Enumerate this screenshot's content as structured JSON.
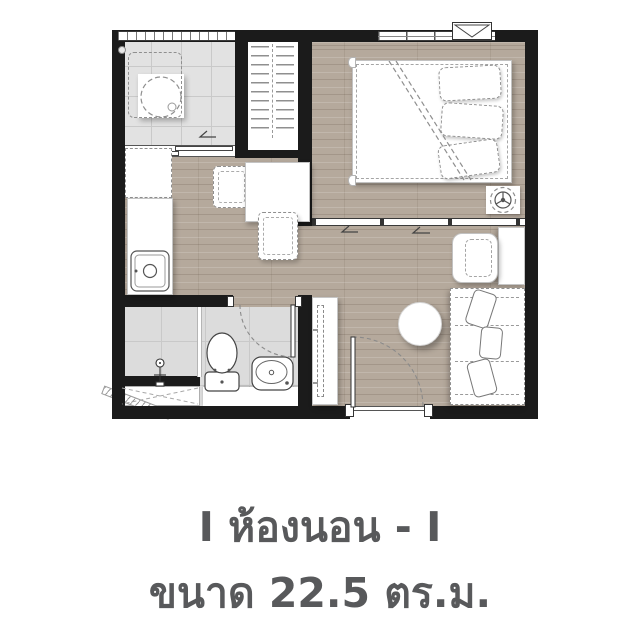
{
  "caption": {
    "line1": "I ห้องนอน - I",
    "line2": "ขนาด 22.5 ตร.ม.",
    "text_color": "#58595b"
  },
  "floorplan": {
    "kind": "condominium unit floor plan, one bedroom",
    "area_value": "22.5",
    "area_unit": "ตร.ม.",
    "colors": {
      "wall": "#1b1b1b",
      "wood_floor": "#b5a99c",
      "tile_floor": "#e2e2e2",
      "furniture_fill": "#ffffff",
      "furniture_outline": "#8f8f8f",
      "caption_text": "#58595b"
    },
    "areas": [
      "balcony-laundry",
      "wardrobe",
      "bedroom",
      "kitchen",
      "dining",
      "living",
      "bathroom",
      "entrance"
    ],
    "fixtures": [
      "washing-machine",
      "wardrobe-hangers",
      "double-bed",
      "bed-pillows",
      "ceiling-fan-symbol",
      "air-conditioner-marker",
      "refrigerator",
      "kitchen-counter",
      "kitchen-sink",
      "dining-table",
      "dining-chairs",
      "tv-console",
      "armchair",
      "side-table",
      "round-table",
      "sofa",
      "sofa-pillows",
      "toilet",
      "wash-basin",
      "shower-mixer",
      "shower-screen",
      "condenser-ledge",
      "drain-hatch",
      "entrance-door",
      "bathroom-door",
      "sliding-partition",
      "balcony-sliding-door",
      "windows"
    ]
  }
}
